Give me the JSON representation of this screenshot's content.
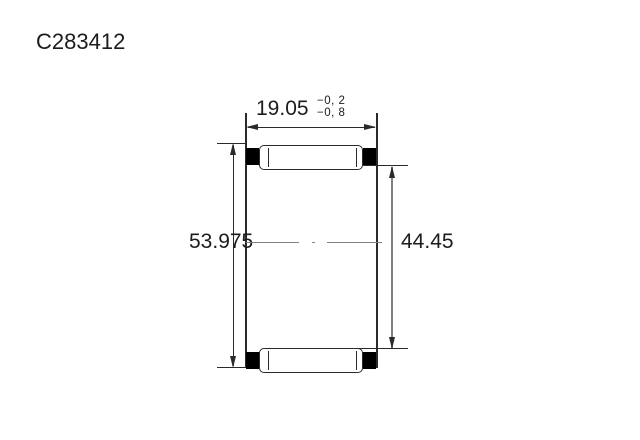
{
  "title": "C283412",
  "dimensions": {
    "width": {
      "value": "19.05",
      "tolerance_upper": "−0, 2",
      "tolerance_lower": "−0, 8"
    },
    "outer_diameter": {
      "value": "53.975"
    },
    "inner_diameter": {
      "value": "44.45"
    }
  },
  "colors": {
    "line": "#2a2a2a",
    "seal": "#000000",
    "dim_gray": "#7f7f7f",
    "text": "#1c1c1c",
    "background": "#ffffff"
  }
}
